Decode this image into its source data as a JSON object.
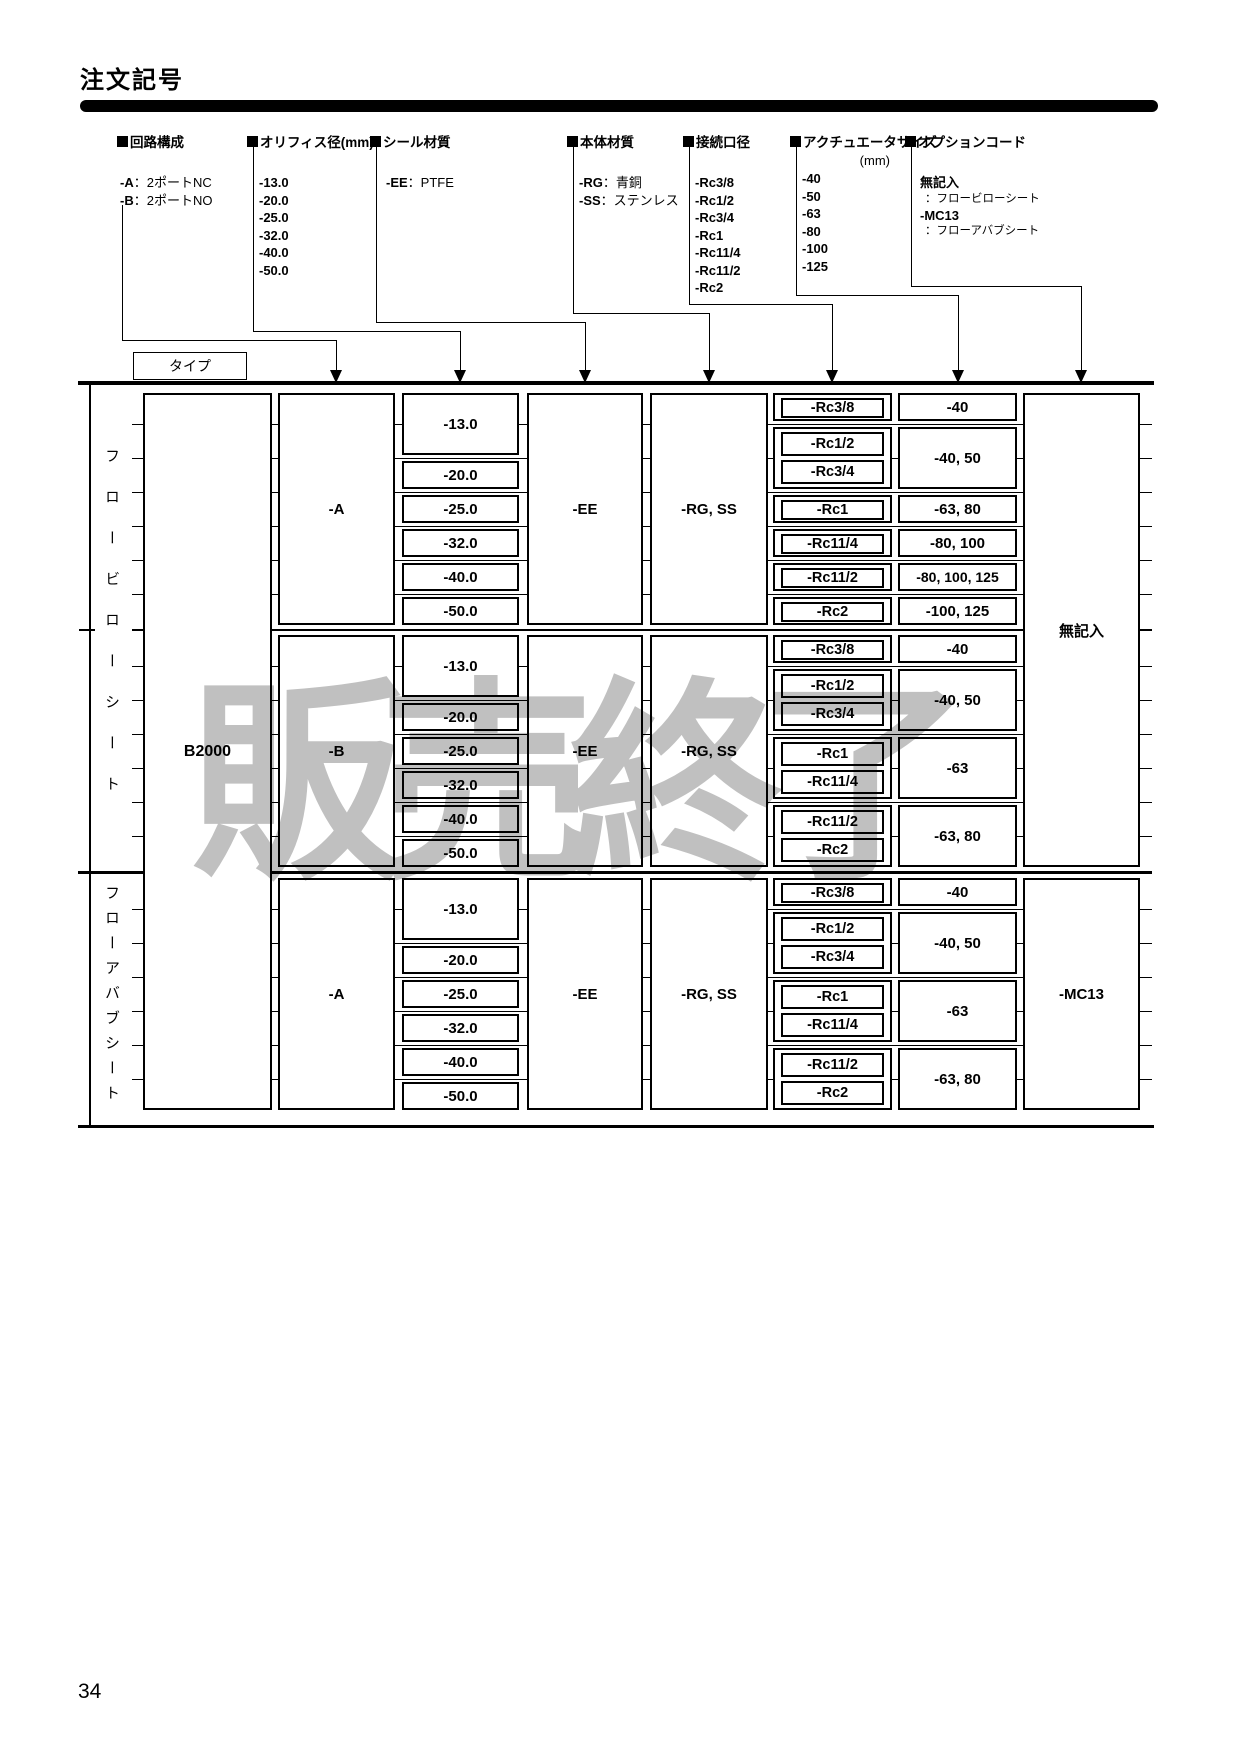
{
  "page": {
    "title": "注文記号",
    "type_label": "タイプ",
    "watermark": "販売終了",
    "page_number": "34"
  },
  "legend": {
    "columns": [
      {
        "heading": "回路構成",
        "items": [
          {
            "code": "-A",
            "desc": "：2ポートNC"
          },
          {
            "code": "-B",
            "desc": "：2ポートNO"
          }
        ]
      },
      {
        "heading": "オリフィス径(mm)",
        "items": [
          {
            "code": "-13.0"
          },
          {
            "code": "-20.0"
          },
          {
            "code": "-25.0"
          },
          {
            "code": "-32.0"
          },
          {
            "code": "-40.0"
          },
          {
            "code": "-50.0"
          }
        ]
      },
      {
        "heading": "シール材質",
        "items": [
          {
            "code": "-EE",
            "desc": "：PTFE"
          }
        ]
      },
      {
        "heading": "本体材質",
        "items": [
          {
            "code": "-RG",
            "desc": "：青銅"
          },
          {
            "code": "-SS",
            "desc": "：ステンレス"
          }
        ]
      },
      {
        "heading": "接続口径",
        "items": [
          {
            "code": "-Rc3/8"
          },
          {
            "code": "-Rc1/2"
          },
          {
            "code": "-Rc3/4"
          },
          {
            "code": "-Rc1"
          },
          {
            "code": "-Rc11/4"
          },
          {
            "code": "-Rc11/2"
          },
          {
            "code": "-Rc2"
          }
        ]
      },
      {
        "heading": "アクチュエータサイズ",
        "unit": "(mm)",
        "items": [
          {
            "code": "-40"
          },
          {
            "code": "-50"
          },
          {
            "code": "-63"
          },
          {
            "code": "-80"
          },
          {
            "code": "-100"
          },
          {
            "code": "-125"
          }
        ]
      },
      {
        "heading": "オプションコード",
        "items": [
          {
            "code": "無記入",
            "desc": "：フロービローシート"
          },
          {
            "code": "-MC13",
            "desc": "：フローアバブシート"
          }
        ]
      }
    ]
  },
  "table": {
    "model": "B2000",
    "groups": [
      {
        "label": "フロービローシート"
      },
      {
        "label": "フローアバブシート"
      }
    ],
    "options": [
      {
        "label": "無記入"
      },
      {
        "label": "-MC13"
      }
    ],
    "sections": [
      {
        "circuit": "-A",
        "seal": "-EE",
        "body": "-RG, SS",
        "orifice": [
          "-13.0",
          "-20.0",
          "-25.0",
          "-32.0",
          "-40.0",
          "-50.0"
        ],
        "ports": [
          "-Rc3/8",
          "-Rc1/2",
          "-Rc3/4",
          "-Rc1",
          "-Rc11/4",
          "-Rc11/2",
          "-Rc2"
        ],
        "actuators": [
          "-40",
          "-40, 50",
          "-63, 80",
          "-80, 100",
          "-80, 100, 125",
          "-100, 125"
        ]
      },
      {
        "circuit": "-B",
        "seal": "-EE",
        "body": "-RG, SS",
        "orifice": [
          "-13.0",
          "-20.0",
          "-25.0",
          "-32.0",
          "-40.0",
          "-50.0"
        ],
        "ports": [
          "-Rc3/8",
          "-Rc1/2",
          "-Rc3/4",
          "-Rc1",
          "-Rc11/4",
          "-Rc11/2",
          "-Rc2"
        ],
        "actuators": [
          "-40",
          "-40, 50",
          "-63",
          "-63, 80"
        ]
      },
      {
        "circuit": "-A",
        "seal": "-EE",
        "body": "-RG, SS",
        "orifice": [
          "-13.0",
          "-20.0",
          "-25.0",
          "-32.0",
          "-40.0",
          "-50.0"
        ],
        "ports": [
          "-Rc3/8",
          "-Rc1/2",
          "-Rc3/4",
          "-Rc1",
          "-Rc11/4",
          "-Rc11/2",
          "-Rc2"
        ],
        "actuators": [
          "-40",
          "-40, 50",
          "-63",
          "-63, 80"
        ]
      }
    ]
  }
}
